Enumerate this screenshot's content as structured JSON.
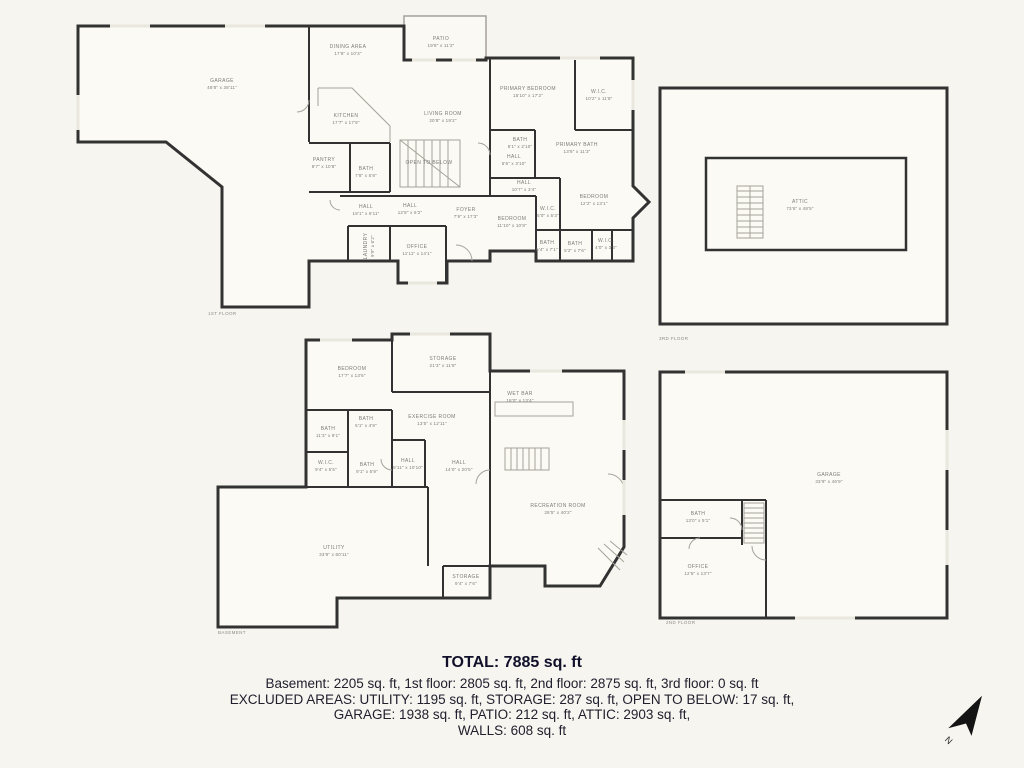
{
  "colors": {
    "background": "#f7f5ef",
    "wall": "#323232",
    "thin_line": "#a5a29a",
    "label_text": "#7d7c76",
    "summary_text": "#20202e"
  },
  "floors": [
    {
      "id": "first-floor",
      "caption": "1ST FLOOR",
      "caption_x": 208,
      "caption_y": 311,
      "rooms": [
        {
          "name": "GARAGE",
          "dims": "48'8\" x 38'11\"",
          "x": 222,
          "y": 84
        },
        {
          "name": "DINING AREA",
          "dims": "17'8\" x 10'3\"",
          "x": 348,
          "y": 50
        },
        {
          "name": "PATIO",
          "dims": "19'8\" x 11'2\"",
          "x": 441,
          "y": 42
        },
        {
          "name": "LIVING ROOM",
          "dims": "20'8\" x 19'2\"",
          "x": 443,
          "y": 117
        },
        {
          "name": "KITCHEN",
          "dims": "17'7\" x 17'9\"",
          "x": 346,
          "y": 119
        },
        {
          "name": "PANTRY",
          "dims": "8'7\" x 10'8\"",
          "x": 324,
          "y": 163
        },
        {
          "name": "BATH",
          "dims": "7'8\" x 5'8\"",
          "x": 366,
          "y": 172
        },
        {
          "name": "PRIMARY BEDROOM",
          "dims": "15'10\" x 17'2\"",
          "x": 528,
          "y": 92
        },
        {
          "name": "W.I.C.",
          "dims": "10'2\" x 11'8\"",
          "x": 599,
          "y": 95
        },
        {
          "name": "PRIMARY BATH",
          "dims": "13'8\" x 11'3\"",
          "x": 577,
          "y": 148
        },
        {
          "name": "BATH",
          "dims": "6'1\" x 2'10\"",
          "x": 520,
          "y": 143
        },
        {
          "name": "HALL",
          "dims": "5'6\" x 3'10\"",
          "x": 514,
          "y": 160
        },
        {
          "name": "HALL",
          "dims": "10'7\" x 3'4\"",
          "x": 524,
          "y": 186
        },
        {
          "name": "OPEN TO BELOW",
          "dims": "",
          "x": 429,
          "y": 163
        },
        {
          "name": "HALL",
          "dims": "18'1\" x 6'11\"",
          "x": 366,
          "y": 210
        },
        {
          "name": "HALL",
          "dims": "12'8\" x 6'2\"",
          "x": 410,
          "y": 209
        },
        {
          "name": "FOYER",
          "dims": "7'9\" x 17'3\"",
          "x": 466,
          "y": 213
        },
        {
          "name": "LAUNDRY",
          "dims": "9'9\" x 6'2\"",
          "x": 369,
          "y": 246,
          "rot": -90
        },
        {
          "name": "OFFICE",
          "dims": "11'11\" x 14'1\"",
          "x": 417,
          "y": 250
        },
        {
          "name": "BEDROOM",
          "dims": "11'10\" x 10'8\"",
          "x": 512,
          "y": 222
        },
        {
          "name": "BEDROOM",
          "dims": "12'2\" x 13'1\"",
          "x": 594,
          "y": 200
        },
        {
          "name": "W.I.C.",
          "dims": "5'0\" x 5'3\"",
          "x": 548,
          "y": 212
        },
        {
          "name": "BATH",
          "dims": "5'4\" x 7'1\"",
          "x": 547,
          "y": 246
        },
        {
          "name": "BATH",
          "dims": "5'2\" x 7'6\"",
          "x": 575,
          "y": 247
        },
        {
          "name": "W.I.C.",
          "dims": "4'0\" x 3'3\"",
          "x": 606,
          "y": 244
        }
      ]
    },
    {
      "id": "third-floor",
      "caption": "3RD FLOOR",
      "caption_x": 659,
      "caption_y": 336,
      "rooms": [
        {
          "name": "ATTIC",
          "dims": "73'6\" x 48'5\"",
          "x": 800,
          "y": 205
        }
      ]
    },
    {
      "id": "basement",
      "caption": "BASEMENT",
      "caption_x": 218,
      "caption_y": 630,
      "rooms": [
        {
          "name": "BEDROOM",
          "dims": "17'7\" x 13'6\"",
          "x": 352,
          "y": 372
        },
        {
          "name": "STORAGE",
          "dims": "21'3\" x 11'8\"",
          "x": 443,
          "y": 362
        },
        {
          "name": "EXERCISE ROOM",
          "dims": "13'5\" x 12'11\"",
          "x": 432,
          "y": 420
        },
        {
          "name": "WET BAR",
          "dims": "18'0\" x 13'4\"",
          "x": 520,
          "y": 397
        },
        {
          "name": "BATH",
          "dims": "5'1\" x 4'9\"",
          "x": 366,
          "y": 422
        },
        {
          "name": "BATH",
          "dims": "11'3\" x 9'1\"",
          "x": 328,
          "y": 432
        },
        {
          "name": "W.I.C.",
          "dims": "9'4\" x 5'5\"",
          "x": 326,
          "y": 466
        },
        {
          "name": "BATH",
          "dims": "9'1\" x 5'9\"",
          "x": 367,
          "y": 468
        },
        {
          "name": "HALL",
          "dims": "8'11\" x 10'10\"",
          "x": 408,
          "y": 464
        },
        {
          "name": "HALL",
          "dims": "14'0\" x 20'5\"",
          "x": 459,
          "y": 466
        },
        {
          "name": "RECREATION ROOM",
          "dims": "28'5\" x 40'2\"",
          "x": 558,
          "y": 509
        },
        {
          "name": "UTILITY",
          "dims": "33'9\" x 60'11\"",
          "x": 334,
          "y": 551
        },
        {
          "name": "STORAGE",
          "dims": "9'4\" x 7'6\"",
          "x": 466,
          "y": 580
        }
      ]
    },
    {
      "id": "second-floor",
      "caption": "2ND FLOOR",
      "caption_x": 666,
      "caption_y": 620,
      "rooms": [
        {
          "name": "GARAGE",
          "dims": "33'9\" x 46'9\"",
          "x": 829,
          "y": 478
        },
        {
          "name": "BATH",
          "dims": "13'0\" x 5'1\"",
          "x": 698,
          "y": 517
        },
        {
          "name": "OFFICE",
          "dims": "12'5\" x 13'7\"",
          "x": 698,
          "y": 570
        }
      ]
    }
  ],
  "summary": {
    "total": "TOTAL: 7885 sq. ft",
    "line1": "Basement: 2205 sq. ft, 1st floor: 2805 sq. ft, 2nd floor: 2875 sq. ft, 3rd floor: 0 sq. ft",
    "line2": "EXCLUDED AREAS: UTILITY: 1195 sq. ft, STORAGE: 287 sq. ft, OPEN TO BELOW: 17 sq. ft,",
    "line3": "GARAGE: 1938 sq. ft, PATIO: 212 sq. ft, ATTIC: 2903 sq. ft,",
    "line4": "WALLS: 608 sq. ft"
  },
  "compass": {
    "label": "N"
  }
}
